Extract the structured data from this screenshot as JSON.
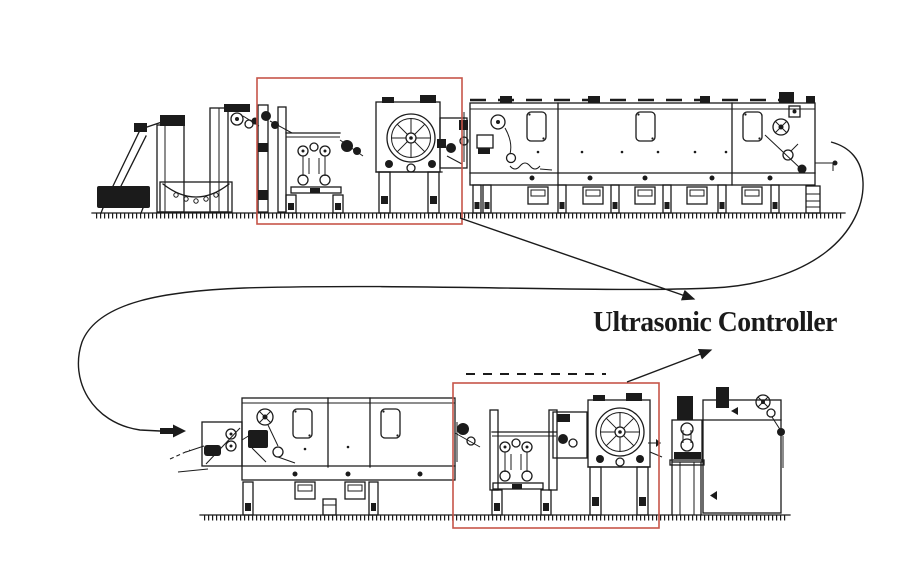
{
  "figure": {
    "annotation_label": "Ultrasonic Controller",
    "colors": {
      "highlight": "#c65549",
      "ink": "#1b1b1b",
      "background": "#ffffff"
    }
  }
}
